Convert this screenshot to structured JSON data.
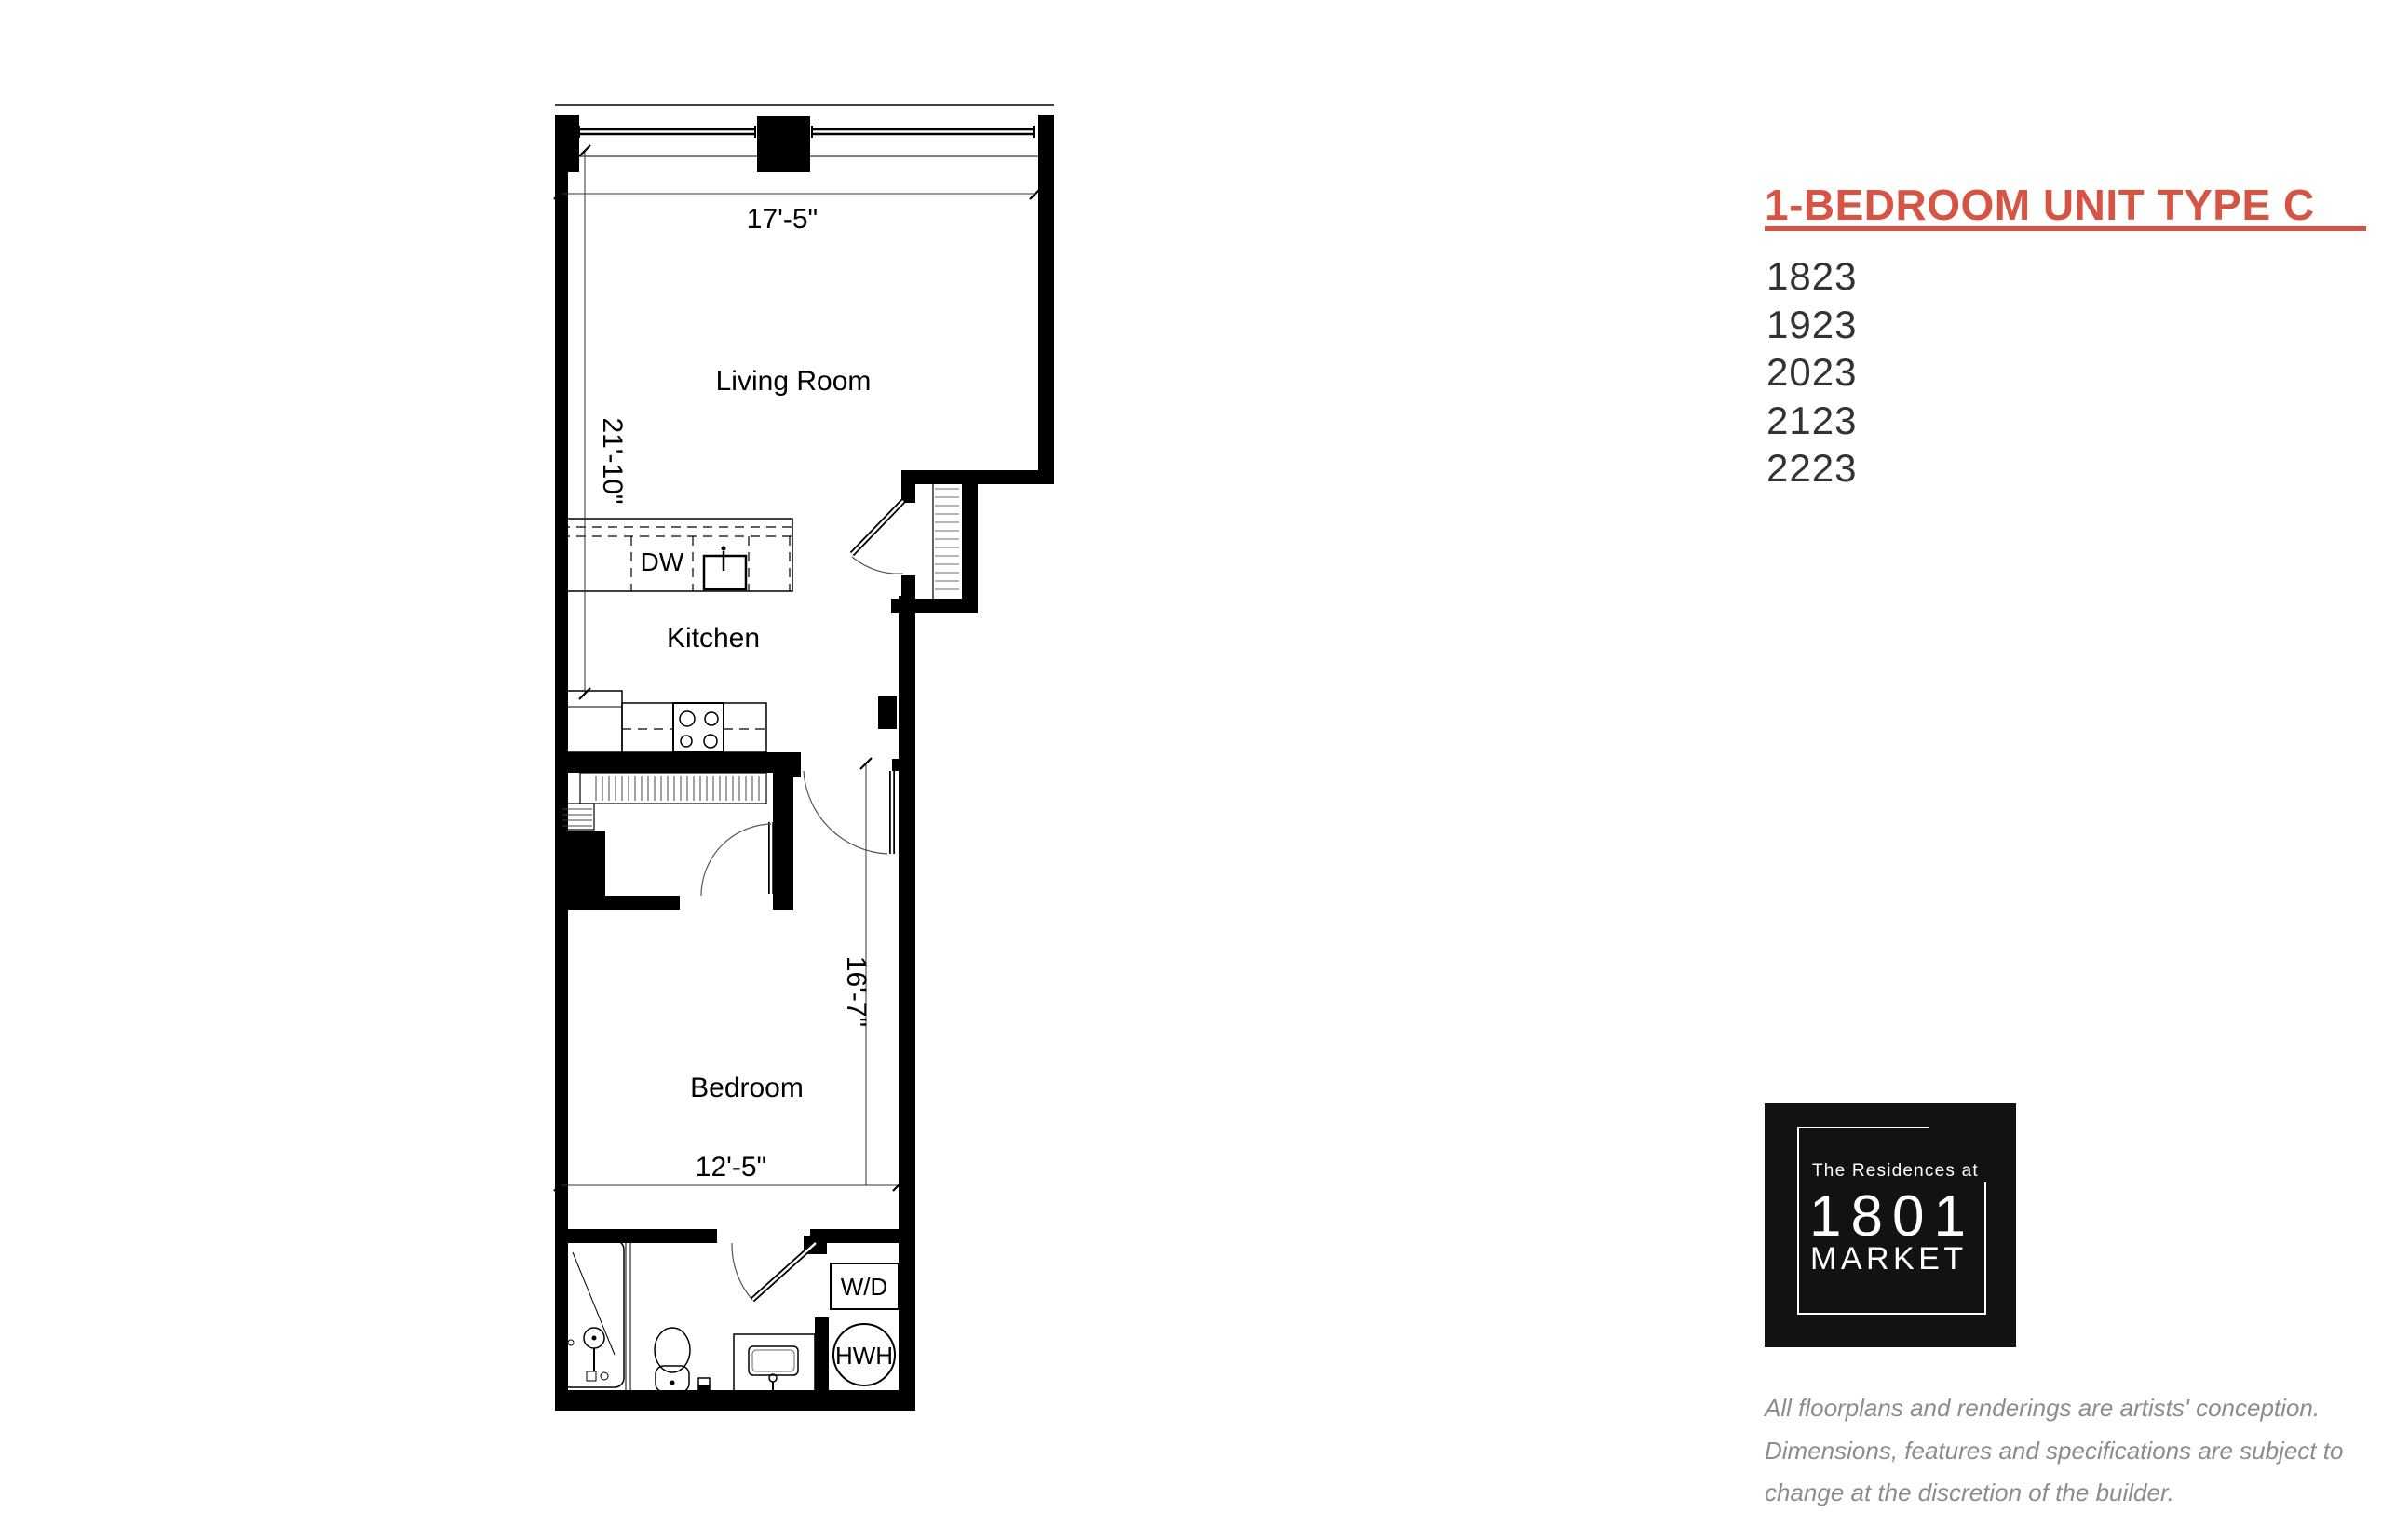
{
  "colors": {
    "accent": "#d65443",
    "plan_line": "#000000",
    "disclaimer_text": "#8c8c8c",
    "logo_bg": "#121212"
  },
  "panel": {
    "title": "1-BEDROOM UNIT TYPE C",
    "units": [
      "1823",
      "1923",
      "2023",
      "2123",
      "2223"
    ],
    "disclaimer": [
      "All floorplans and renderings are artists' conception.",
      "Dimensions, features and specifications are subject to",
      "change at the discretion of the builder."
    ]
  },
  "logo": {
    "tagline": "The Residences at",
    "number": "1801",
    "name": "MARKET"
  },
  "plan": {
    "rooms": {
      "living": "Living Room",
      "kitchen": "Kitchen",
      "bedroom": "Bedroom"
    },
    "fixtures": {
      "dishwasher": "DW",
      "washer_dryer": "W/D",
      "water_heater": "HWH"
    },
    "dimensions": {
      "living_width": "17'-5\"",
      "unit_depth": "21'-10\"",
      "bedroom_depth": "16'-7\"",
      "bedroom_width": "12'-5\""
    }
  }
}
